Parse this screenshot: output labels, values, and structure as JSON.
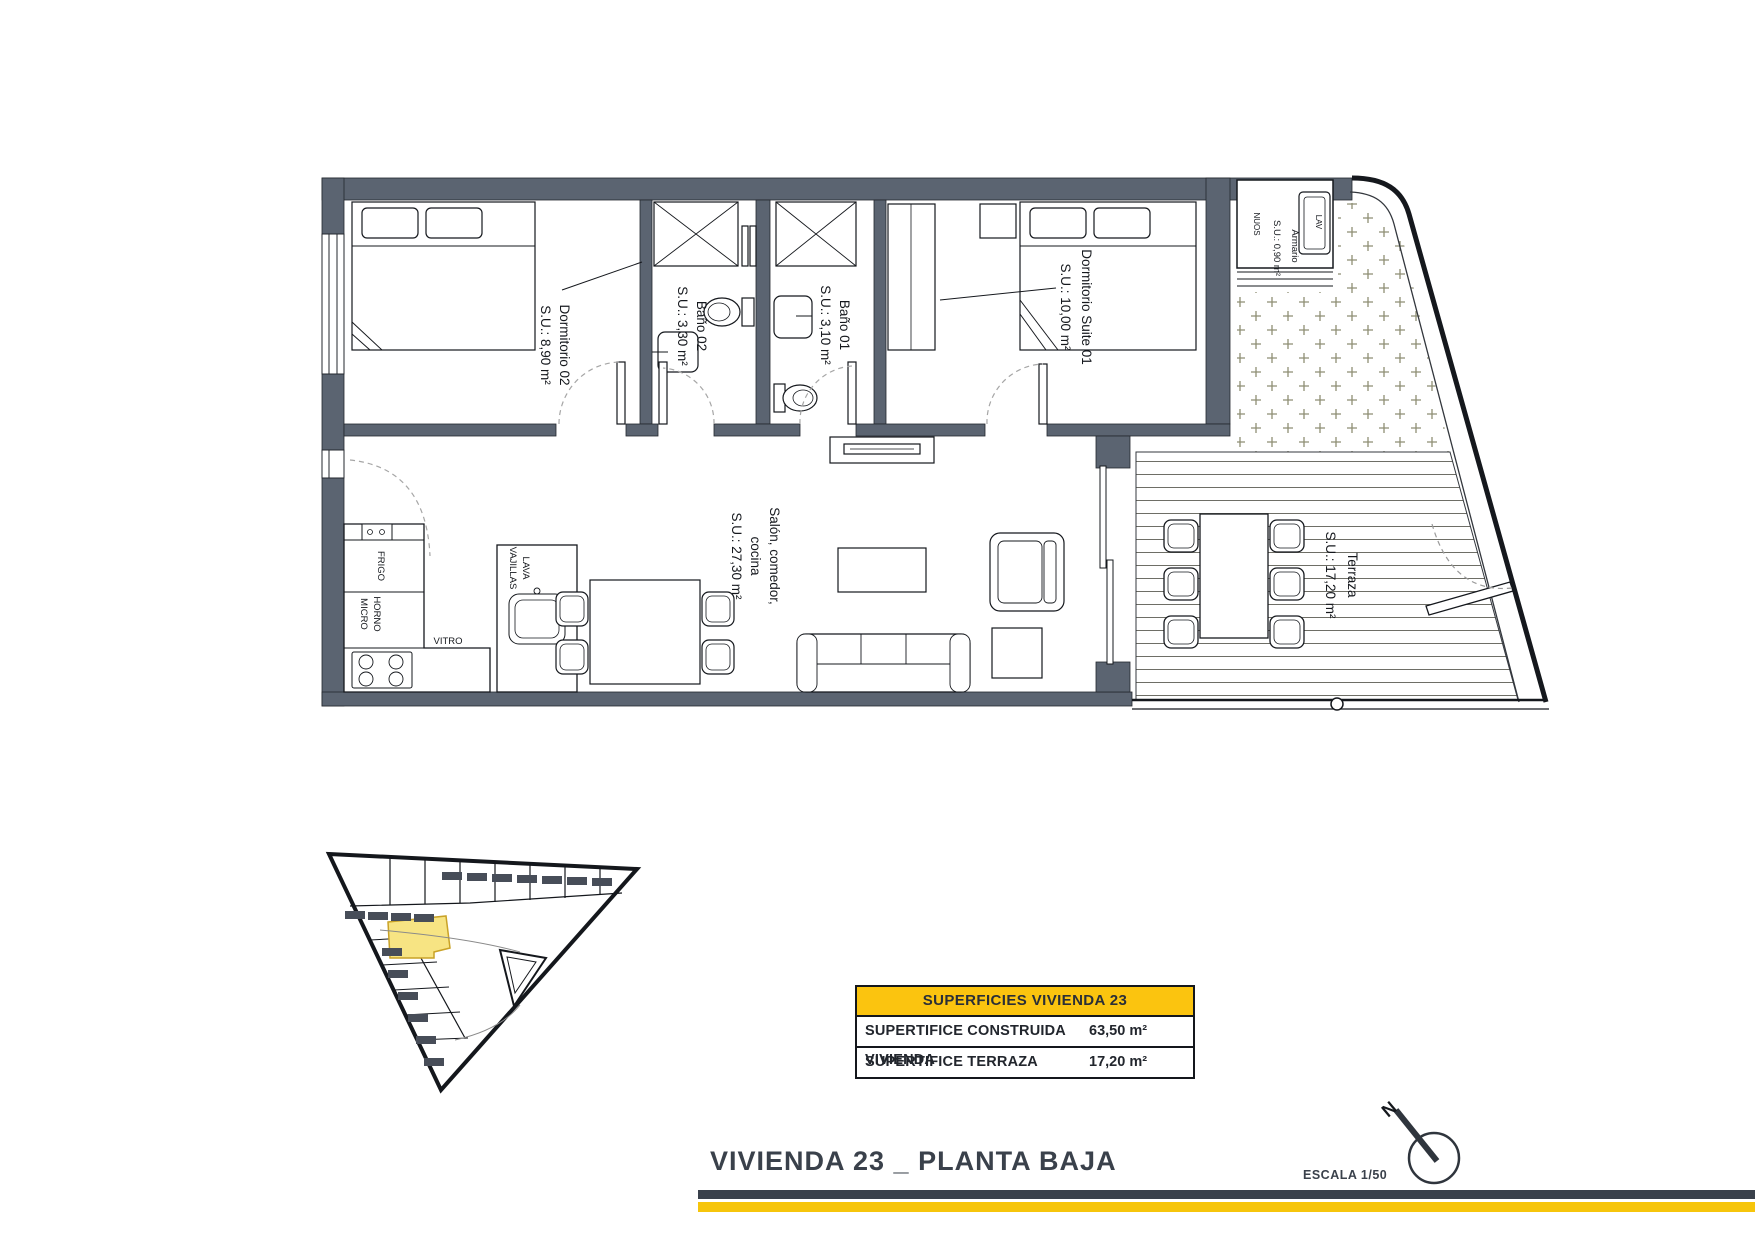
{
  "title": {
    "text": "VIVIENDA 23 _ PLANTA BAJA"
  },
  "scale": {
    "label": "ESCALA 1/50"
  },
  "north": {
    "label": "N"
  },
  "rooms": {
    "dormitorio02": {
      "name": "Dormitorio 02",
      "area": "S.U.: 8,90 m²"
    },
    "bano02": {
      "name": "Baño 02",
      "area": "S.U.: 3,30 m²"
    },
    "bano01": {
      "name": "Baño 01",
      "area": "S.U.: 3,10 m²"
    },
    "suite01": {
      "name": "Dormitorio Suite 01",
      "area": "S.U.: 10,00 m²"
    },
    "armario": {
      "name": "Armario",
      "area": "S.U.: 0,90 m²",
      "unit_label": "NUOS",
      "washer_label": "LAV"
    },
    "salon": {
      "line1": "Salón, comedor,",
      "line2": "cocina",
      "area": "S.U.: 27,30 m²"
    },
    "terraza": {
      "name": "Terraza",
      "area": "S.U.: 17,20 m²"
    }
  },
  "kitchen": {
    "frigo": "FRIGO",
    "horno": "HORNO",
    "micro": "MICRO",
    "vitro": "VITRO",
    "lava": "LAVA",
    "vajillas": "VAJILLAS"
  },
  "summary_table": {
    "header": "SUPERFICIES VIVIENDA 23",
    "rows": [
      {
        "label": "SUPERTIFICE CONSTRUIDA VIVIENDA",
        "value": "63,50 m²"
      },
      {
        "label": "SUPERTIFICE TERRAZA",
        "value": "17,20 m²"
      }
    ]
  },
  "colors": {
    "wall": "#5b6471",
    "accent_yellow": "#f6c50b",
    "table_header_yellow": "#fbc40f",
    "highlight_unit_yellow": "#f7e483",
    "title_dark": "#3a414b"
  }
}
